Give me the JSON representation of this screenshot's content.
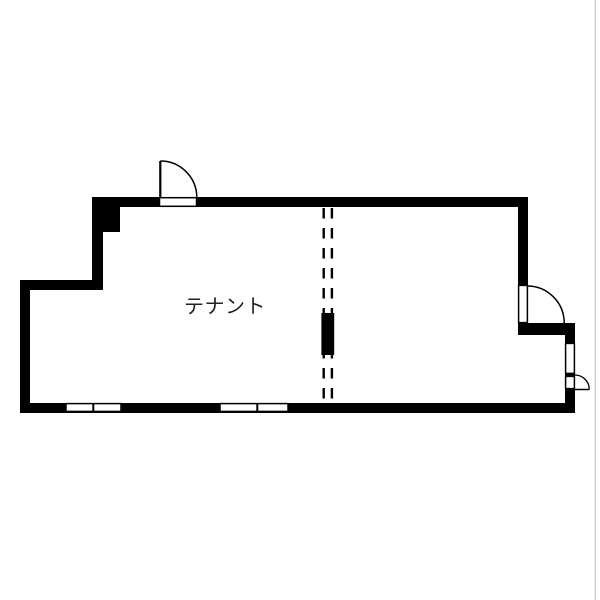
{
  "room": {
    "label": "テナント"
  },
  "colors": {
    "background": "#ffffff",
    "wall": "#000000",
    "line": "#000000",
    "label": "#222222",
    "frame_line": "#c9c9c9"
  }
}
